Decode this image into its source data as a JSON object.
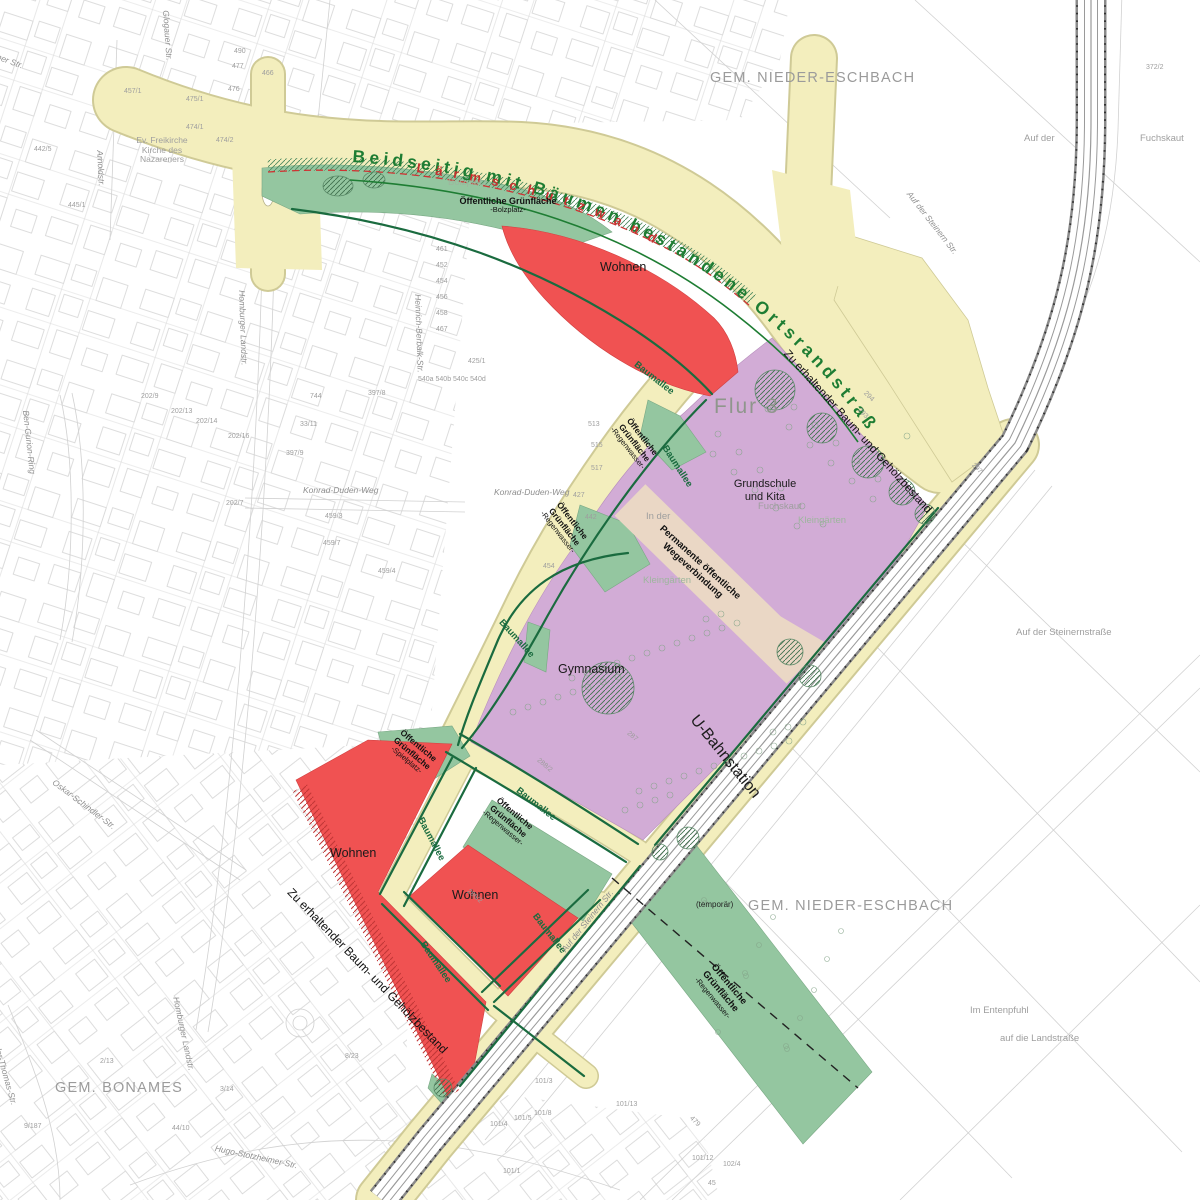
{
  "map": {
    "title_road": "Beidseitig mit Bäumen bestandene Ortsrandstraße",
    "noise_wall": "Lärmschutzwand"
  },
  "labels": {
    "municipality_top": "GEM. NIEDER-ESCHBACH",
    "municipality_bottom_right": "GEM. NIEDER-ESCHBACH",
    "municipality_bottom_left": "GEM. BONAMES",
    "wohnen": "Wohnen",
    "gymnasium": "Gymnasium",
    "grundschule_line1": "Grundschule",
    "grundschule_line2": "und Kita",
    "flur": "Flur 3",
    "ubahn": "U-Bahnstation",
    "oeff_line1": "Öffentliche",
    "oeff_line2": "Grünfläche",
    "oeff_one_line": "Öffentliche Grünfläche",
    "suffix_bolzplatz": "-Bolzplatz-",
    "suffix_spielplatz": "-Spielplatz-",
    "suffix_regenwasser": "-Regenwasser-",
    "bolzplatz_gray": "Bolzplatz",
    "baumallee": "Baumallee",
    "zu_erhaltender": "Zu erhaltender Baum- und Gehölzbestand",
    "perm_line1": "Permanente öffentliche",
    "perm_line2": "Wegeverbindung",
    "temporaer": "(temporär)",
    "kirche_line1": "Ev. Freikirche",
    "kirche_line2": "Kirche des",
    "kirche_line3": "Nazareners"
  },
  "colors": {
    "yellow": "#f3eebd",
    "yellowedge": "#cfca96",
    "green": "#94c6a0",
    "red": "#f05252",
    "purple": "#d2acd6",
    "tan": "#ead7c5",
    "dkgreen": "#1a6b3f",
    "titlegreen": "#1e7d33",
    "redtext": "#c62f2f",
    "gray": "#9e9e9e",
    "linegray": "#c6c6c6"
  },
  "minor_labels": [
    {
      "t": "Berner Str.",
      "x": -14,
      "y": 48,
      "r": 20,
      "c": "st"
    },
    {
      "t": "Glogauer Str.",
      "x": 170,
      "y": 10,
      "r": 86,
      "c": "st"
    },
    {
      "t": "Arnoldstr.",
      "x": 104,
      "y": 150,
      "r": 87,
      "c": "st"
    },
    {
      "t": "Homburger Landstr.",
      "x": 246,
      "y": 290,
      "r": 88,
      "c": "st"
    },
    {
      "t": "Homburger Landstr.",
      "x": 180,
      "y": 996,
      "r": 78,
      "c": "st"
    },
    {
      "t": "Ben-Gurion-Ring",
      "x": 30,
      "y": 410,
      "r": 84,
      "c": "st"
    },
    {
      "t": "Oskar-Schindler-Str.",
      "x": 56,
      "y": 778,
      "r": 37,
      "c": "st"
    },
    {
      "t": "Theodor-Thomas-Str.",
      "x": -4,
      "y": 1026,
      "r": 74,
      "c": "st"
    },
    {
      "t": "Hugo-Stotzheimer-Str.",
      "x": 216,
      "y": 1144,
      "r": 12,
      "c": "st"
    },
    {
      "t": "Heinrich-Berbalk-Str.",
      "x": 422,
      "y": 294,
      "r": 88,
      "c": "st"
    },
    {
      "t": "Konrad-Duden-Weg",
      "x": 303,
      "y": 486,
      "r": 0,
      "c": "st"
    },
    {
      "t": "Konrad-Duden-Weg",
      "x": 494,
      "y": 488,
      "r": 0,
      "c": "st"
    },
    {
      "t": "Auf der Steinern Str.",
      "x": 912,
      "y": 190,
      "r": 52,
      "c": "st"
    },
    {
      "t": "Auf der Steinern Str.",
      "x": 560,
      "y": 948,
      "r": -51,
      "c": "st"
    },
    {
      "t": "Auf der",
      "x": 1024,
      "y": 134,
      "r": 0,
      "c": "geo"
    },
    {
      "t": "Fuchskaut",
      "x": 1140,
      "y": 134,
      "r": 0,
      "c": "geo"
    },
    {
      "t": "Fuchskaut",
      "x": 758,
      "y": 502,
      "r": 0,
      "c": "geo"
    },
    {
      "t": "Kleingärten",
      "x": 798,
      "y": 516,
      "r": 0,
      "c": "gg"
    },
    {
      "t": "Kleingärten",
      "x": 643,
      "y": 576,
      "r": 0,
      "c": "gg"
    },
    {
      "t": "In der",
      "x": 646,
      "y": 512,
      "r": 0,
      "c": "geo"
    },
    {
      "t": "Auf der Steinernstraße",
      "x": 1016,
      "y": 628,
      "r": 0,
      "c": "geo"
    },
    {
      "t": "Im Entenpfuhl",
      "x": 970,
      "y": 1006,
      "r": 0,
      "c": "geo"
    },
    {
      "t": "auf die Landstraße",
      "x": 1000,
      "y": 1034,
      "r": 0,
      "c": "geo"
    },
    {
      "t": "457/1",
      "x": 124,
      "y": 88
    },
    {
      "t": "475/1",
      "x": 186,
      "y": 96
    },
    {
      "t": "476",
      "x": 228,
      "y": 86
    },
    {
      "t": "477",
      "x": 232,
      "y": 63
    },
    {
      "t": "474/1",
      "x": 186,
      "y": 124
    },
    {
      "t": "474/2",
      "x": 216,
      "y": 137
    },
    {
      "t": "490",
      "x": 234,
      "y": 48
    },
    {
      "t": "466",
      "x": 262,
      "y": 70
    },
    {
      "t": "442/5",
      "x": 34,
      "y": 146
    },
    {
      "t": "445/1",
      "x": 68,
      "y": 202
    },
    {
      "t": "372/2",
      "x": 1146,
      "y": 64
    },
    {
      "t": "202/9",
      "x": 141,
      "y": 393
    },
    {
      "t": "202/13",
      "x": 171,
      "y": 408
    },
    {
      "t": "202/14",
      "x": 196,
      "y": 418
    },
    {
      "t": "202/16",
      "x": 228,
      "y": 433
    },
    {
      "t": "202/7",
      "x": 226,
      "y": 500
    },
    {
      "t": "397/9",
      "x": 286,
      "y": 450
    },
    {
      "t": "397/8",
      "x": 368,
      "y": 390
    },
    {
      "t": "33/11",
      "x": 300,
      "y": 421
    },
    {
      "t": "744",
      "x": 310,
      "y": 393
    },
    {
      "t": "459/3",
      "x": 325,
      "y": 513
    },
    {
      "t": "459/7",
      "x": 323,
      "y": 540
    },
    {
      "t": "459/4",
      "x": 378,
      "y": 568
    },
    {
      "t": "427",
      "x": 573,
      "y": 492
    },
    {
      "t": "442",
      "x": 585,
      "y": 514
    },
    {
      "t": "454",
      "x": 543,
      "y": 563
    },
    {
      "t": "425/1",
      "x": 468,
      "y": 358
    },
    {
      "t": "513",
      "x": 588,
      "y": 421
    },
    {
      "t": "515",
      "x": 591,
      "y": 442
    },
    {
      "t": "517",
      "x": 591,
      "y": 465
    },
    {
      "t": "461",
      "x": 436,
      "y": 246
    },
    {
      "t": "452",
      "x": 436,
      "y": 262
    },
    {
      "t": "454",
      "x": 436,
      "y": 278
    },
    {
      "t": "456",
      "x": 436,
      "y": 294
    },
    {
      "t": "458",
      "x": 436,
      "y": 310
    },
    {
      "t": "467",
      "x": 436,
      "y": 326
    },
    {
      "t": "540a 540b 540c 540d",
      "x": 418,
      "y": 376
    },
    {
      "t": "2/13",
      "x": 100,
      "y": 1058
    },
    {
      "t": "3/14",
      "x": 220,
      "y": 1086
    },
    {
      "t": "44/10",
      "x": 172,
      "y": 1125
    },
    {
      "t": "8/23",
      "x": 345,
      "y": 1053
    },
    {
      "t": "9/187",
      "x": 24,
      "y": 1123
    },
    {
      "t": "101/3",
      "x": 535,
      "y": 1078
    },
    {
      "t": "101/8",
      "x": 534,
      "y": 1110
    },
    {
      "t": "101/5",
      "x": 514,
      "y": 1115
    },
    {
      "t": "101/4",
      "x": 490,
      "y": 1121
    },
    {
      "t": "101/13",
      "x": 616,
      "y": 1101
    },
    {
      "t": "101/1",
      "x": 503,
      "y": 1168
    },
    {
      "t": "479",
      "x": 693,
      "y": 1115,
      "r": 45
    },
    {
      "t": "101/12",
      "x": 692,
      "y": 1155
    },
    {
      "t": "102/4",
      "x": 723,
      "y": 1161
    },
    {
      "t": "45",
      "x": 708,
      "y": 1180
    },
    {
      "t": "288/2",
      "x": 540,
      "y": 757,
      "r": 40
    },
    {
      "t": "287",
      "x": 630,
      "y": 730,
      "r": 40
    },
    {
      "t": "286/2",
      "x": 470,
      "y": 888,
      "r": 40
    },
    {
      "t": "294",
      "x": 867,
      "y": 390,
      "r": 45
    },
    {
      "t": "293",
      "x": 861,
      "y": 407,
      "r": 45
    },
    {
      "t": "297",
      "x": 975,
      "y": 462,
      "r": 45
    }
  ]
}
